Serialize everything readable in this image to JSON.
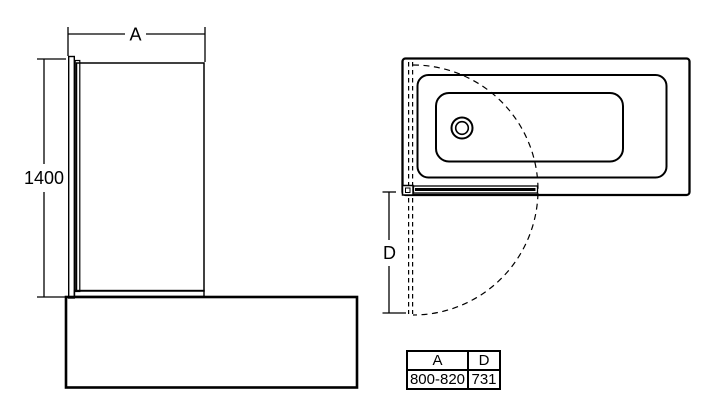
{
  "front_view": {
    "width_dim_label": "A",
    "height_dim_label": "1400"
  },
  "plan_view": {
    "depth_dim_label": "D"
  },
  "spec_table": {
    "headers": [
      "A",
      "D"
    ],
    "values": [
      "800-820",
      "731"
    ]
  },
  "colors": {
    "line": "#000000",
    "background": "#ffffff"
  }
}
